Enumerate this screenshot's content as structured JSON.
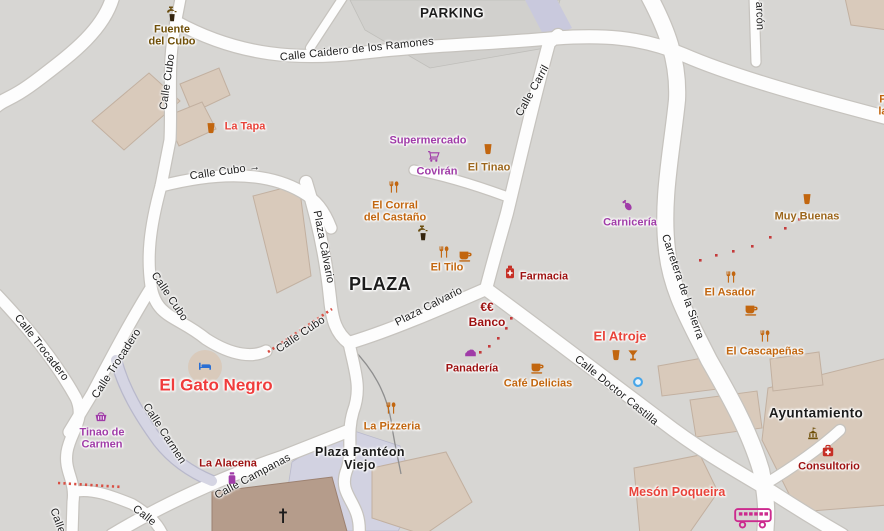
{
  "map": {
    "background_color": "#d7d6d3",
    "colors": {
      "food": "#c2660f",
      "bar": "#9c661c",
      "shop": "#a03ca8",
      "red": "#e8433a",
      "brightred": "#f03c3c",
      "darkred": "#9d1111",
      "civic": "#6f4f08",
      "hotel": "#2a6fd4",
      "black": "#1c1c1c",
      "magenta": "#cc2a8e",
      "pharm": "#c62f25",
      "water": "#47a6e9",
      "road_fill": "#fdfdfd",
      "building_fill": "#d9cabb",
      "pedestrian_fill": "#d5d5e3",
      "trail_red": "#c43b3b"
    },
    "places": [
      {
        "lines": [
          "PARKING"
        ],
        "x": 452,
        "y": 13,
        "fs": 13.5
      },
      {
        "lines": [
          "PLAZA"
        ],
        "x": 380,
        "y": 284,
        "fs": 18
      },
      {
        "lines": [
          "Plaza Pantéon",
          "Viejo"
        ],
        "x": 360,
        "y": 452,
        "fs": 12.5,
        "lh": 13
      },
      {
        "lines": [
          "Ayuntamiento"
        ],
        "x": 816,
        "y": 413,
        "fs": 13.5
      }
    ],
    "streets": [
      {
        "t": "Calle Caidero de los Ramones",
        "x": 357,
        "y": 50,
        "r": -6
      },
      {
        "t": "Calle Cubo",
        "x": 168,
        "y": 82,
        "r": -82
      },
      {
        "t": "Calle Cubo →",
        "x": 225,
        "y": 172,
        "r": -8
      },
      {
        "t": "Calle Cubo",
        "x": 169,
        "y": 297,
        "r": 56
      },
      {
        "t": "Calle Cubo",
        "x": 301,
        "y": 335,
        "r": -34
      },
      {
        "t": "Calle Trocadero",
        "x": 41,
        "y": 348,
        "r": 52
      },
      {
        "t": "Calle Trocadero",
        "x": 117,
        "y": 364,
        "r": -57
      },
      {
        "t": "Calle Carril",
        "x": 533,
        "y": 91,
        "r": -61
      },
      {
        "t": "Plaza Càlvario",
        "x": 323,
        "y": 247,
        "r": 79
      },
      {
        "t": "Plaza Calvario",
        "x": 429,
        "y": 307,
        "r": -27
      },
      {
        "t": "Calle Doctor Castilla",
        "x": 616,
        "y": 391,
        "r": 39
      },
      {
        "t": "Carretera de la Sierra",
        "x": 682,
        "y": 287,
        "r": 71
      },
      {
        "t": "Calle Carmen",
        "x": 164,
        "y": 434,
        "r": 57
      },
      {
        "t": "Calle Campanas",
        "x": 253,
        "y": 477,
        "r": -28
      },
      {
        "t": "Calle",
        "x": 57,
        "y": 521,
        "r": 70
      },
      {
        "t": "Calle",
        "x": 144,
        "y": 516,
        "r": 38
      },
      {
        "t": "arcón",
        "x": 759,
        "y": 16,
        "r": 88
      }
    ],
    "pois": [
      {
        "icon": "fountain",
        "ix": 172,
        "iy": 13,
        "ic": "civic",
        "lines": [
          "Fuente",
          "del Cubo"
        ],
        "x": 172,
        "y": 30,
        "c": "civic"
      },
      {
        "icon": "cup",
        "ix": 211,
        "iy": 128,
        "ic": "food",
        "lines": [
          "La Tapa"
        ],
        "x": 245,
        "y": 127,
        "c": "red"
      },
      {
        "lines": [
          "Supermercado"
        ],
        "x": 428,
        "y": 141,
        "c": "shop"
      },
      {
        "icon": "cart",
        "ix": 434,
        "iy": 156,
        "ic": "shop",
        "lines": [
          "Covirán"
        ],
        "x": 437,
        "y": 172,
        "c": "shop"
      },
      {
        "icon": "cup",
        "ix": 488,
        "iy": 149,
        "ic": "food",
        "lines": [
          "El Tinao"
        ],
        "x": 489,
        "y": 168,
        "c": "bar"
      },
      {
        "icon": "restaurant",
        "ix": 394,
        "iy": 187,
        "ic": "food",
        "lines": [
          "El Corral",
          "del Castaño"
        ],
        "x": 395,
        "y": 206,
        "c": "food"
      },
      {
        "icon": "fountain",
        "ix": 423,
        "iy": 232,
        "ic": "civic"
      },
      {
        "icon": "restaurant",
        "ix": 444,
        "iy": 252,
        "ic": "food"
      },
      {
        "icon": "coffee",
        "ix": 465,
        "iy": 255,
        "ic": "food",
        "lines": [
          "El Tilo"
        ],
        "x": 447,
        "y": 268,
        "c": "food"
      },
      {
        "icon": "pharmacy",
        "ix": 510,
        "iy": 272,
        "ic": "pharm",
        "lines": [
          "Farmacia"
        ],
        "x": 544,
        "y": 277,
        "c": "darkred"
      },
      {
        "lines": [
          "€€",
          "Banco"
        ],
        "x": 487,
        "y": 307,
        "c": "darkred",
        "fs": 12,
        "lh": 15
      },
      {
        "icon": "bread",
        "ix": 471,
        "iy": 352,
        "ic": "shop",
        "lines": [
          "Panadería"
        ],
        "x": 472,
        "y": 369,
        "c": "darkred"
      },
      {
        "icon": "coffee",
        "ix": 537,
        "iy": 367,
        "ic": "food",
        "lines": [
          "Café Delicias"
        ],
        "x": 538,
        "y": 384,
        "c": "food"
      },
      {
        "lines": [
          "El Atroje"
        ],
        "x": 620,
        "y": 336,
        "c": "red",
        "fs": 13
      },
      {
        "icon": "cup",
        "ix": 616,
        "iy": 355,
        "ic": "food"
      },
      {
        "icon": "cocktail",
        "ix": 633,
        "iy": 355,
        "ic": "food"
      },
      {
        "icon": "meat",
        "ix": 628,
        "iy": 205,
        "ic": "shop",
        "lines": [
          "Carnicería"
        ],
        "x": 630,
        "y": 223,
        "c": "shop"
      },
      {
        "icon": "cup",
        "ix": 807,
        "iy": 199,
        "ic": "food",
        "lines": [
          "Muy Buenas"
        ],
        "x": 807,
        "y": 217,
        "c": "bar"
      },
      {
        "icon": "restaurant",
        "ix": 731,
        "iy": 277,
        "ic": "food",
        "lines": [
          "El Asador"
        ],
        "x": 730,
        "y": 293,
        "c": "food"
      },
      {
        "icon": "coffee",
        "ix": 751,
        "iy": 309,
        "ic": "food"
      },
      {
        "icon": "restaurant",
        "ix": 765,
        "iy": 336,
        "ic": "food",
        "lines": [
          "El Cascapeñas"
        ],
        "x": 765,
        "y": 352,
        "c": "food"
      },
      {
        "icon": "bed",
        "ix": 205,
        "iy": 366,
        "ic": "hotel",
        "lines": [
          "El Gato Negro"
        ],
        "x": 216,
        "y": 385,
        "c": "brightred",
        "fs": 17
      },
      {
        "icon": "basket",
        "ix": 101,
        "iy": 416,
        "ic": "shop",
        "lines": [
          "Tinao de",
          "Carmen"
        ],
        "x": 102,
        "y": 433,
        "c": "shop"
      },
      {
        "icon": "jar",
        "ix": 232,
        "iy": 478,
        "ic": "shop",
        "lines": [
          "La Alacena"
        ],
        "x": 228,
        "y": 464,
        "c": "darkred"
      },
      {
        "icon": "restaurant",
        "ix": 391,
        "iy": 408,
        "ic": "food",
        "lines": [
          "La Pizzeria"
        ],
        "x": 392,
        "y": 427,
        "c": "food"
      },
      {
        "lines": [
          "Mesón Poqueira"
        ],
        "x": 677,
        "y": 492,
        "c": "red",
        "fs": 12.5
      },
      {
        "icon": "townhall",
        "ix": 813,
        "iy": 434,
        "ic": "civic"
      },
      {
        "icon": "firstaid",
        "ix": 828,
        "iy": 451,
        "ic": "pharm",
        "lines": [
          "Consultorio"
        ],
        "x": 829,
        "y": 467,
        "c": "darkred"
      },
      {
        "icon": "bus",
        "ix": 754,
        "iy": 518,
        "ic": "magenta"
      },
      {
        "icon": "waterdot",
        "ix": 638,
        "iy": 382
      },
      {
        "icon": "cross",
        "ix": 283,
        "iy": 516,
        "ic": "black"
      },
      {
        "lines": [
          "Fu",
          "las"
        ],
        "x": 886,
        "y": 100,
        "c": "food"
      }
    ]
  }
}
